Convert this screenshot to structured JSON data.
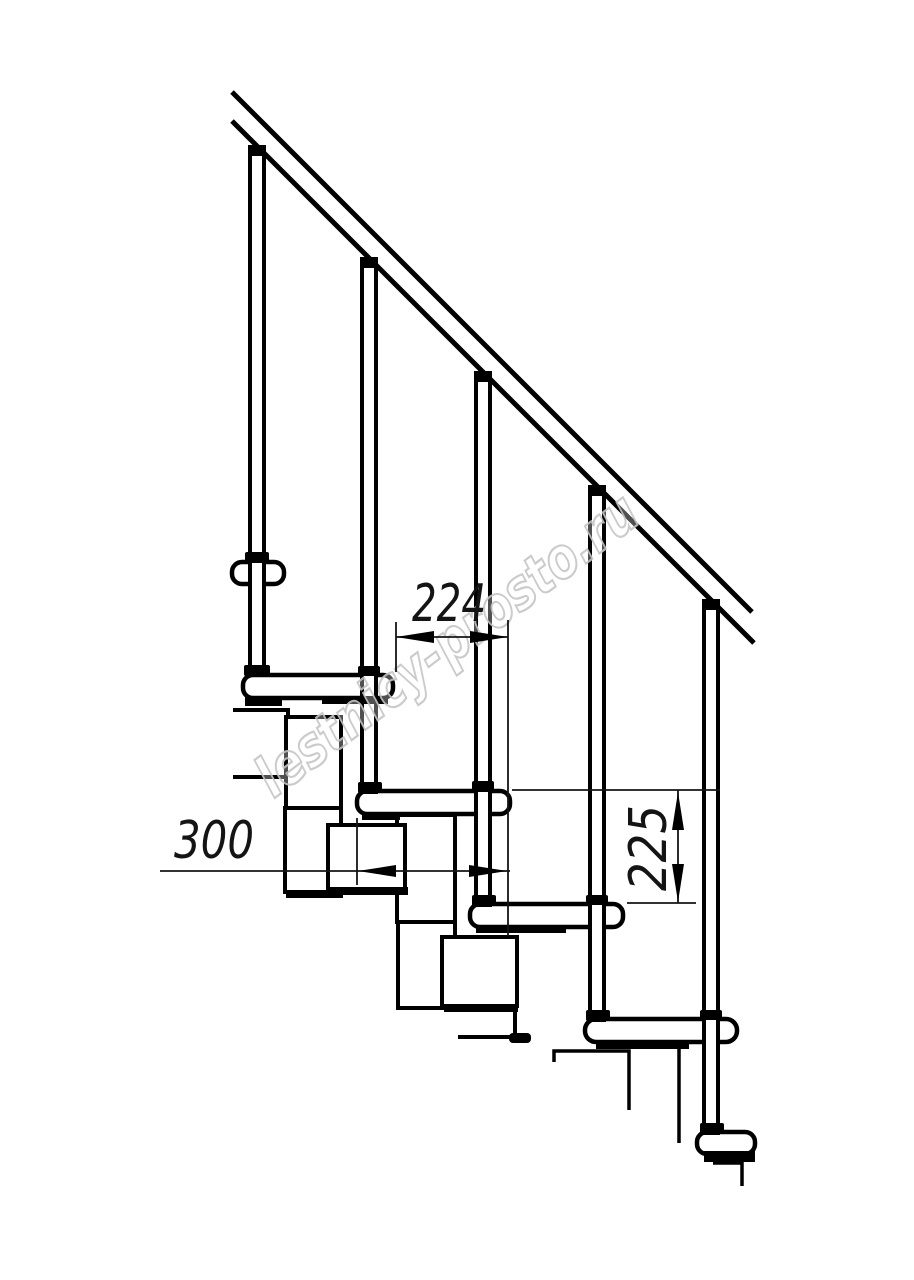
{
  "drawing": {
    "type": "modular staircase side-view technical drawing",
    "watermark": {
      "text": "lestnicy-prosto.ru",
      "color": "#c6c6c6"
    },
    "dimensions": {
      "step_run": {
        "value": "224"
      },
      "tread_depth": {
        "value": "300"
      },
      "step_rise": {
        "value": "225"
      }
    },
    "colors": {
      "line": "#000000",
      "dimension": "#141414",
      "background": "#ffffff"
    }
  }
}
